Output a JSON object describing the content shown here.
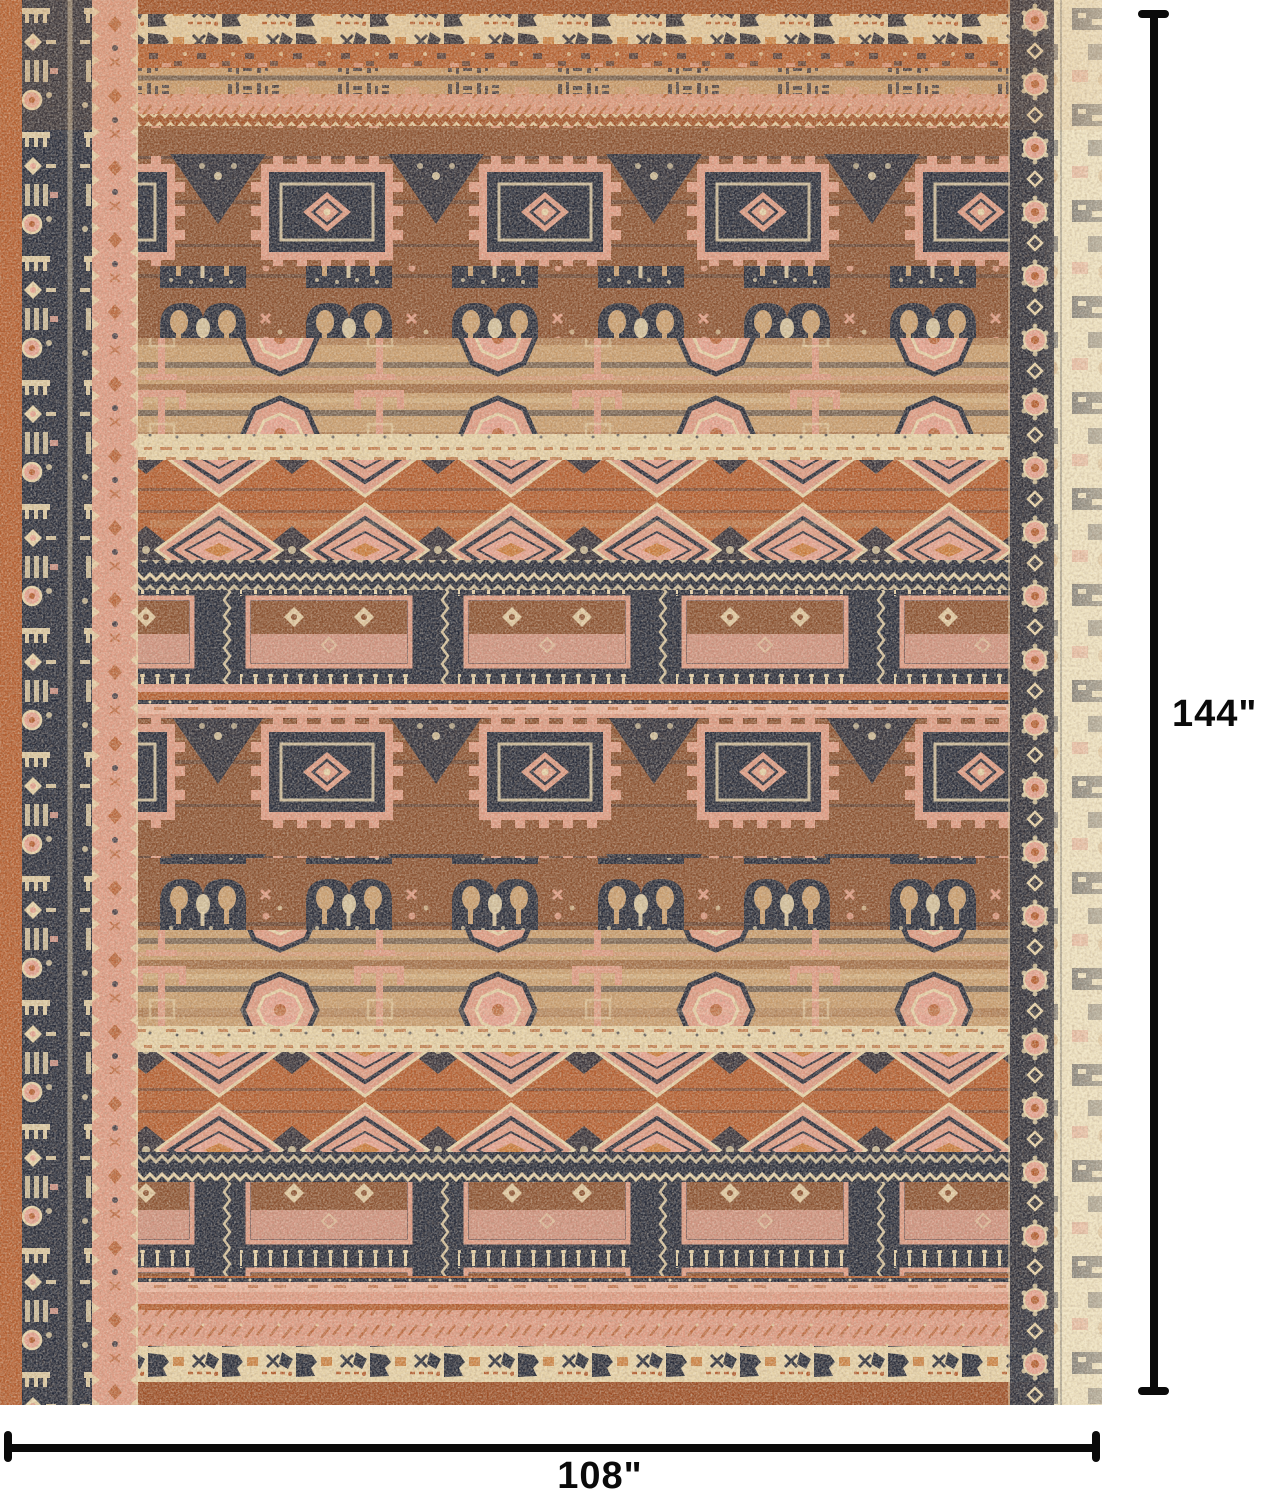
{
  "dimensions": {
    "height_label": "144\"",
    "width_label": "108\""
  },
  "colors": {
    "navy": "#262b3a",
    "navyd": "#1c2130",
    "rust": "#b35d2f",
    "rustd": "#9c4e26",
    "orange": "#c97a3a",
    "salmon": "#dd9a83",
    "salmonl": "#e9b39d",
    "pink": "#e4a18f",
    "brown": "#8a5130",
    "tan": "#c89d6e",
    "cream": "#e6d2a8",
    "creaml": "#efe3c0",
    "line": "#0a0a0a",
    "bg": "#ffffff"
  }
}
